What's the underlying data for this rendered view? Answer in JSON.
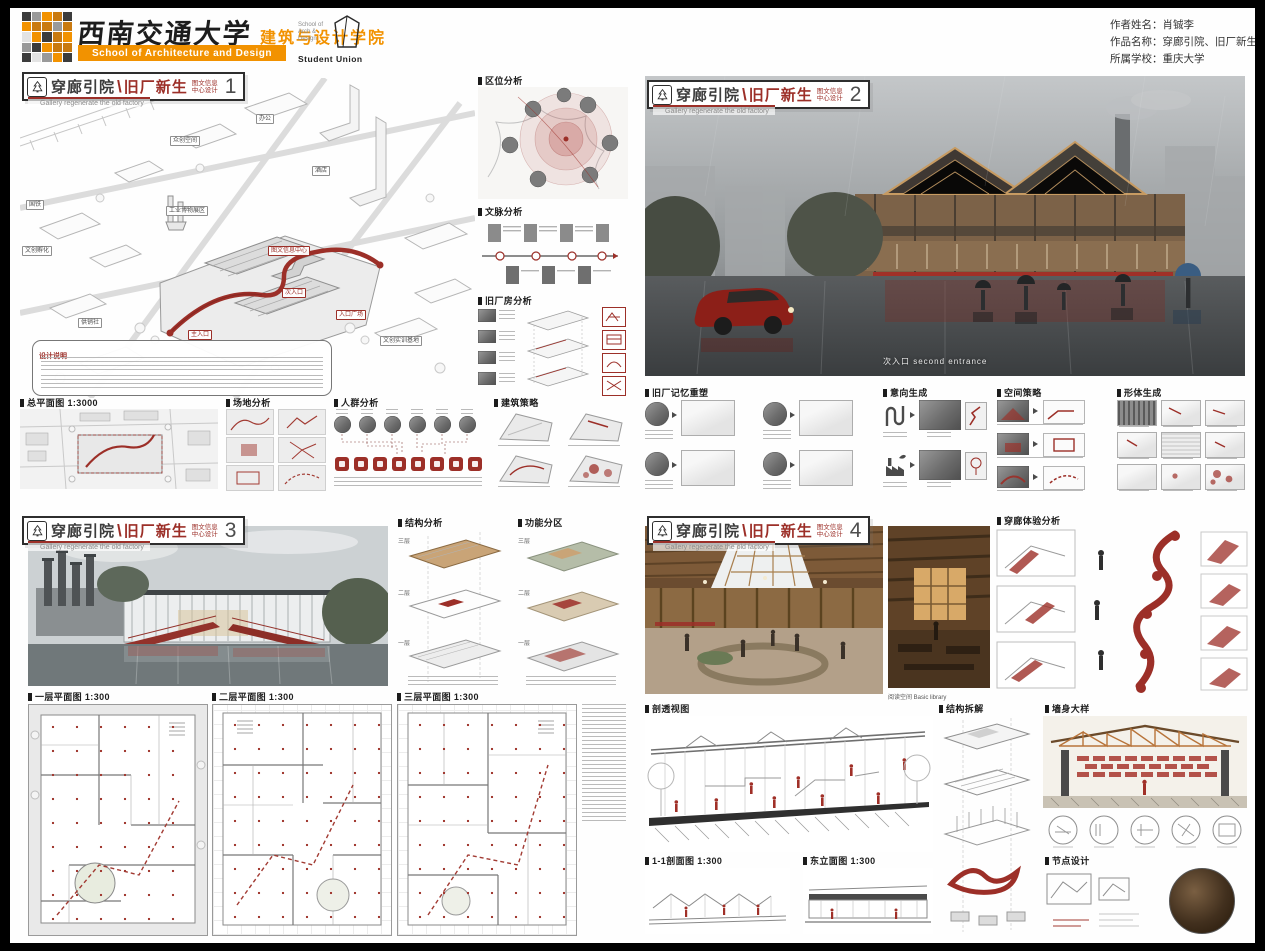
{
  "colors": {
    "accent_red": "#9c2f28",
    "brand_orange": "#f29200",
    "line_gray": "#b5b5b5",
    "ink": "#2b2b2b"
  },
  "header": {
    "university_cn": "西南交通大学",
    "school_cn": "建筑与设计学院",
    "school_en": "School of Architecture and Design",
    "union": {
      "small": "School of Arch & Design",
      "label": "Student Union"
    },
    "info": [
      {
        "label": "作者姓名：",
        "value": "肖铖李"
      },
      {
        "label": "作品名称：",
        "value": "穿廊引院、旧厂新生"
      },
      {
        "label": "所属学校：",
        "value": "重庆大学"
      }
    ]
  },
  "p1": {
    "title": {
      "p1": "穿廊引院",
      "sep": "\\",
      "p2": "旧厂新生",
      "sub": "图文信息中心设计",
      "num": "1",
      "en": "Gallery regenerate the old factory"
    },
    "site_labels": [
      "办公",
      "众创空间",
      "国铁",
      "酒店",
      "工业博物展区",
      "图文信息中心",
      "文创孵化",
      "主入口",
      "次入口",
      "入口广场",
      "文创实训基地",
      "供销社"
    ],
    "sec": {
      "location": "区位分析",
      "context": "文脉分析",
      "factory": "旧厂房分析",
      "note": "设计说明",
      "siteplan": "总平面图 1:3000",
      "site": "场地分析",
      "crowd": "人群分析",
      "strategy": "建筑策略"
    },
    "crowd_icons": [
      "bus-icon",
      "store-icon",
      "food-icon",
      "museum-icon",
      "book-icon",
      "stage-icon",
      "study-icon",
      "time-icon"
    ]
  },
  "p2": {
    "title": {
      "p1": "穿廊引院",
      "sep": "\\",
      "p2": "旧厂新生",
      "sub": "图文信息中心设计",
      "num": "2",
      "en": "Gallery regenerate the old factory"
    },
    "caption": "次入口  second entrance",
    "sec": {
      "memory": "旧厂记忆重塑",
      "intent": "意向生成",
      "space": "空间策略",
      "mass": "形体生成"
    }
  },
  "p3": {
    "title": {
      "p1": "穿廊引院",
      "sep": "\\",
      "p2": "旧厂新生",
      "sub": "图文信息中心设计",
      "num": "3",
      "en": "Gallery regenerate the old factory"
    },
    "sec": {
      "structure": "结构分析",
      "zoning": "功能分区"
    },
    "floors": [
      "三层",
      "二层",
      "一层"
    ],
    "plans": [
      "一层平面图 1:300",
      "二层平面图 1:300",
      "三层平面图 1:300"
    ]
  },
  "p4": {
    "title": {
      "p1": "穿廊引院",
      "sep": "\\",
      "p2": "旧厂新生",
      "sub": "图文信息中心设计",
      "num": "4",
      "en": "Gallery regenerate the old factory"
    },
    "caption": "阅读空间  Basic library",
    "sec": {
      "gallery": "穿廊体验分析",
      "persp": "剖透视图",
      "sec11": "1-1剖面图 1:300",
      "elev": "东立面图 1:300",
      "tect": "结构拆解",
      "wall": "墙身大样",
      "node": "节点设计"
    }
  }
}
